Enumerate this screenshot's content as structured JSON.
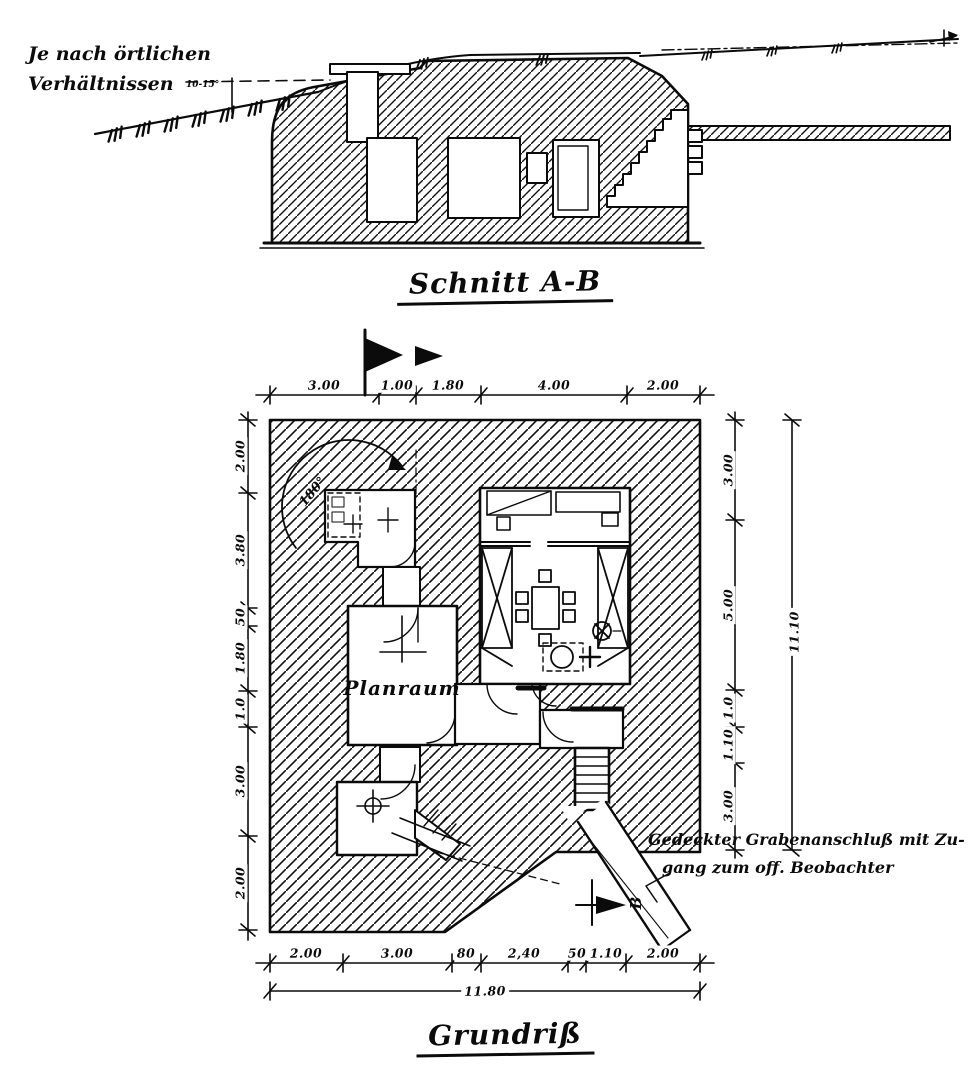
{
  "section": {
    "title": "Schnitt A-B",
    "terrain_note_line1": "Je nach örtlichen",
    "terrain_note_line2": "Verhältnissen",
    "slope_angle_label": "10-15°"
  },
  "plan": {
    "title": "Grundriß",
    "room_label": "Planraum",
    "traverse_arc_label": "180°",
    "section_marker_b_label": "B",
    "annotation_line1": "Gedeckter  Grabenanschluß mit Zu-",
    "annotation_line2": "gang zum off. Beobachter",
    "dims_top": [
      "3.00",
      "1.00",
      "1.80",
      "4.00",
      "2.00"
    ],
    "dims_bottom": [
      "2.00",
      "3.00",
      "80",
      "2,40",
      "50",
      "1.10",
      "2.00"
    ],
    "dims_bottom_total": "11.80",
    "dims_left": [
      "2.00",
      "3.80",
      "50",
      "1.80",
      "1.0",
      "3.00",
      "2.00"
    ],
    "dims_right": [
      "3.00",
      "5.00",
      "1.0",
      "1.10",
      "3.00"
    ],
    "dims_right_total": "11.10"
  }
}
